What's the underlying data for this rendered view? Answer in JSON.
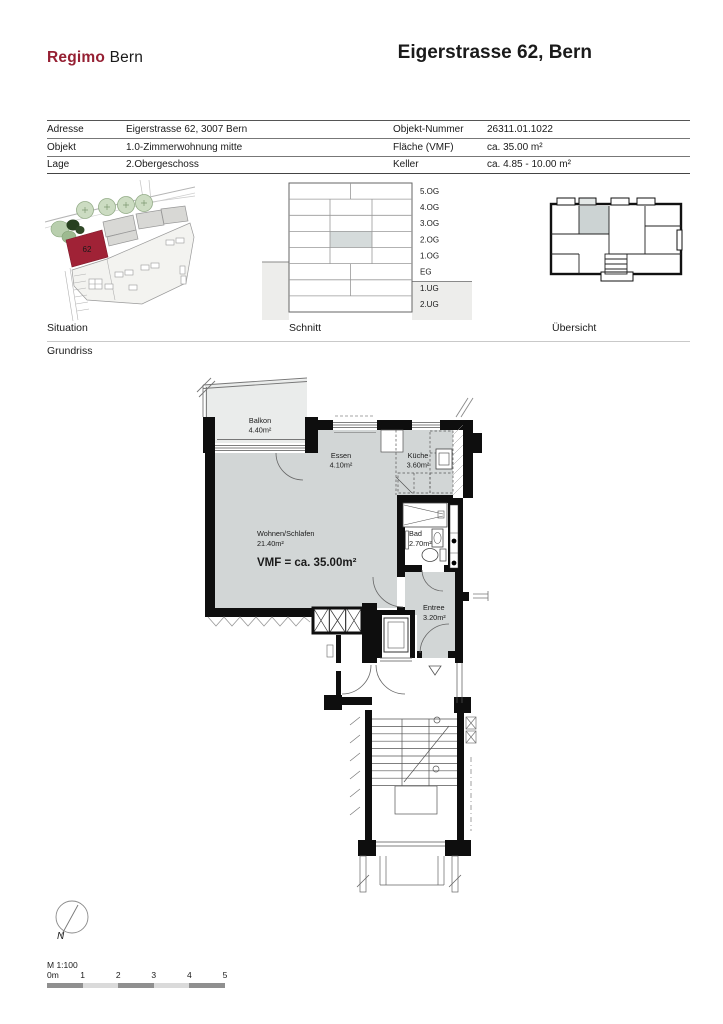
{
  "header": {
    "logo": {
      "primary": "Regimo",
      "secondary": "Bern"
    },
    "title": "Eigerstrasse 62, Bern"
  },
  "info_table": {
    "rows": [
      {
        "label_left": "Adresse",
        "value_left": "Eigerstrasse 62, 3007 Bern",
        "label_right": "Objekt-Nummer",
        "value_right": "26311.01.1022"
      },
      {
        "label_left": "Objekt",
        "value_left": "1.0-Zimmerwohnung mitte",
        "label_right": "Fläche (VMF)",
        "value_right": "ca. 35.00 m²"
      },
      {
        "label_left": "Lage",
        "value_left": "2.Obergeschoss",
        "label_right": "Keller",
        "value_right": "ca. 4.85 - 10.00 m²"
      }
    ]
  },
  "diagrams": {
    "situation": {
      "label": "Situation",
      "building_number": "62"
    },
    "schnitt": {
      "label": "Schnitt",
      "floors": [
        "5.OG",
        "4.OG",
        "3.OG",
        "2.OG",
        "1.OG",
        "EG",
        "1.UG",
        "2.UG"
      ],
      "highlighted_floor": "2.OG"
    },
    "uebersicht": {
      "label": "Übersicht"
    },
    "grundriss_label": "Grundriss"
  },
  "floor_plan": {
    "rooms": {
      "balkon": {
        "name": "Balkon",
        "area": "4.40m²"
      },
      "essen": {
        "name": "Essen",
        "area": "4.10m²"
      },
      "kueche": {
        "name": "Küche",
        "area": "3.60m²"
      },
      "wohnen": {
        "name": "Wohnen/Schlafen",
        "area": "21.40m²"
      },
      "bad": {
        "name": "Bad",
        "area": "2.70m²"
      },
      "entree": {
        "name": "Entree",
        "area": "3.20m²"
      }
    },
    "vmf_label": "VMF = ca. 35.00m²"
  },
  "footer": {
    "north": "N",
    "scale": "M 1:100",
    "ticks": [
      "0m",
      "1",
      "2",
      "3",
      "4",
      "5"
    ]
  },
  "colors": {
    "accent_red": "#a02236",
    "plan_room_gray": "#d2d6d6",
    "plan_balcony_gray": "#eaeceb",
    "schnitt_highlight": "#d5dbdb",
    "ground_gray": "#ededeb"
  }
}
